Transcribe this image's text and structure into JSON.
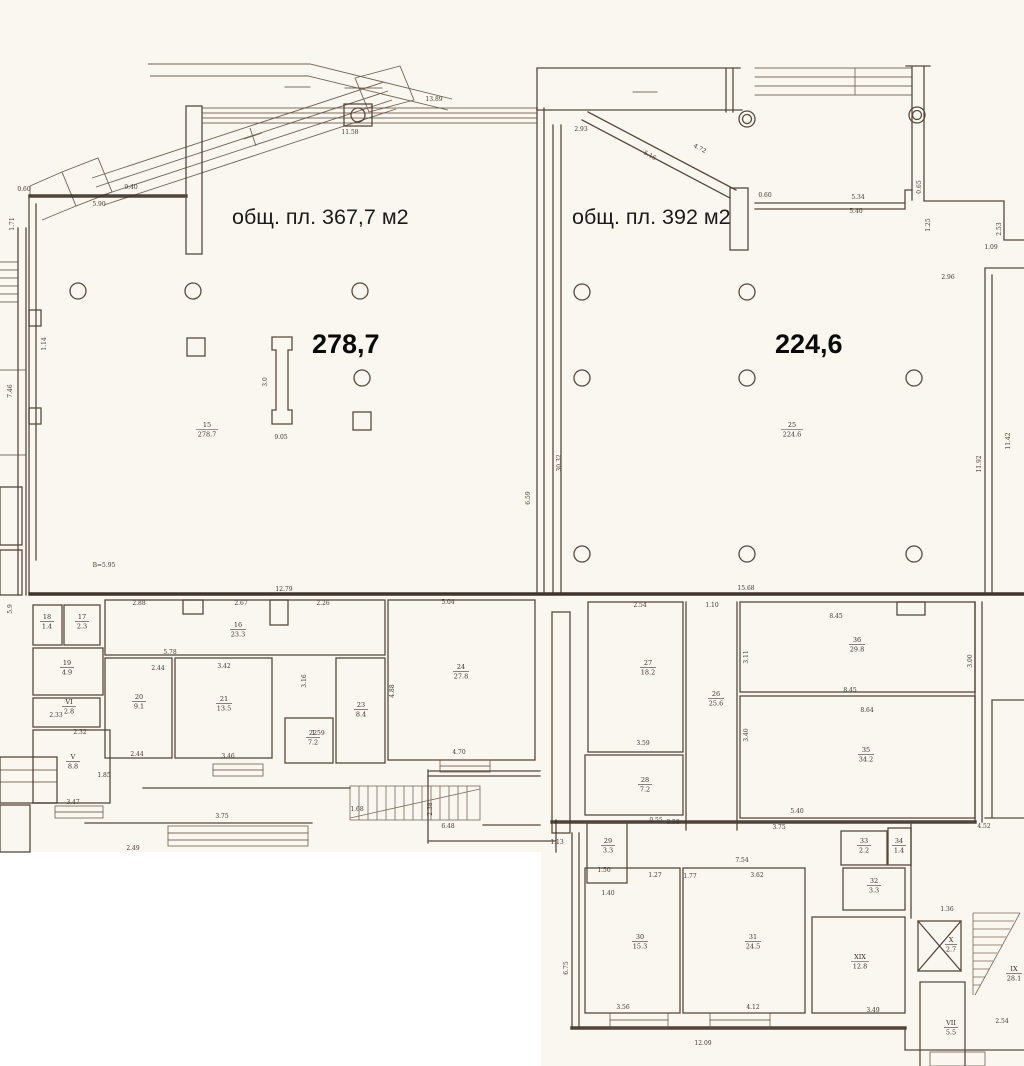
{
  "colors": {
    "paper": "#faf7f0",
    "ink": "#4b3a2e",
    "heavy_wall": "#362a21",
    "label_text": "#161616"
  },
  "halls": {
    "left": {
      "caption": "общ. пл. 367,7 м2",
      "big": "278,7",
      "tag_num": "15",
      "tag_area": "278.7"
    },
    "right": {
      "caption": "общ. пл. 392 м2",
      "big": "224,6",
      "tag_num": "25",
      "tag_area": "224.6"
    }
  },
  "rooms": [
    {
      "num": "18",
      "area": "1.4"
    },
    {
      "num": "17",
      "area": "2.3"
    },
    {
      "num": "19",
      "area": "4.9"
    },
    {
      "num": "VI",
      "area": "2.8"
    },
    {
      "num": "V",
      "area": "8.8"
    },
    {
      "num": "16",
      "area": "23.3"
    },
    {
      "num": "20",
      "area": "9.1"
    },
    {
      "num": "21",
      "area": "13.5"
    },
    {
      "num": "22",
      "area": "7.2"
    },
    {
      "num": "23",
      "area": "8.4"
    },
    {
      "num": "24",
      "area": "27.8"
    },
    {
      "num": "27",
      "area": "18.2"
    },
    {
      "num": "28",
      "area": "7.2"
    },
    {
      "num": "26",
      "area": "25.6"
    },
    {
      "num": "36",
      "area": "29.8"
    },
    {
      "num": "35",
      "area": "34.2"
    },
    {
      "num": "29",
      "area": "3.3"
    },
    {
      "num": "30",
      "area": "15.3"
    },
    {
      "num": "31",
      "area": "24.5"
    },
    {
      "num": "XIX",
      "area": "12.8"
    },
    {
      "num": "32",
      "area": "3.3"
    },
    {
      "num": "33",
      "area": "2.2"
    },
    {
      "num": "34",
      "area": "1.4"
    },
    {
      "num": "X",
      "area": "2.7"
    },
    {
      "num": "VII",
      "area": "5.5"
    },
    {
      "num": "IX",
      "area": "28.1"
    }
  ],
  "dims": [
    "9.40",
    "5.90",
    "0.60",
    "1.71",
    "11.58",
    "13.89",
    "2.93",
    "5.16",
    "4.72",
    "0.60",
    "5.34",
    "5.40",
    "0.65",
    "1.25",
    "2.53",
    "1.09",
    "2.96",
    "30.32",
    "6.59",
    "11.92",
    "11.42",
    "15.68",
    "12.79",
    "В=5.95",
    "9.05",
    "3.0",
    "1.14",
    "7.46",
    "2.88",
    "2.67",
    "2.26",
    "5.04",
    "5.78",
    "2.44",
    "3.42",
    "2.33",
    "2.32",
    "1.85",
    "3.47",
    "2.44",
    "3.46",
    "4.70",
    "3.16",
    "1.59",
    "4.88",
    "3.75",
    "2.49",
    "1.68",
    "2.38",
    "6.48",
    "1.13",
    "5.9",
    "2.54",
    "1.10",
    "8.45",
    "3.11",
    "8.45",
    "8.64",
    "3.40",
    "3.00",
    "3.59",
    "5.40",
    "3.75",
    "0.55",
    "3.58",
    "7.54",
    "3.62",
    "1.27",
    "1.50",
    "1.40",
    "1.77",
    "6.75",
    "3.56",
    "4.12",
    "3.49",
    "12.09",
    "2.54",
    "1.36",
    "4.52"
  ]
}
